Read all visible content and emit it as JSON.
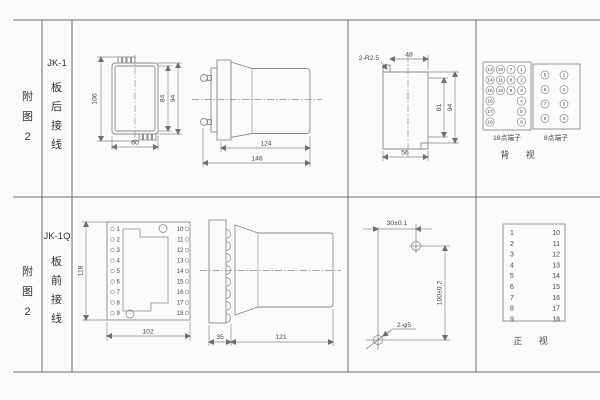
{
  "row1": {
    "fig": "附图2",
    "model": "JK-1",
    "wiring": "板后接线",
    "rear_view": {
      "d_height": "106",
      "d_inner": "84",
      "d_outer": "94",
      "d_width": "60"
    },
    "side_view": {
      "d_body": "124",
      "d_total": "146"
    },
    "cutout": {
      "note": "2-R2.5",
      "d_top": "48",
      "d_inner_h": "81",
      "d_outer_h": "94",
      "d_bottom": "56"
    },
    "block18": {
      "label": "18点端子",
      "rows": [
        [
          "13",
          "10",
          "7",
          "1"
        ],
        [
          "14",
          "11",
          "8",
          "2"
        ],
        [
          "15",
          "12",
          "9",
          "3"
        ],
        [
          "16",
          "4"
        ],
        [
          "17",
          "5"
        ],
        [
          "18",
          "6"
        ]
      ]
    },
    "block8": {
      "label": "8点端子",
      "rows": [
        [
          "5",
          "1"
        ],
        [
          "6",
          "2"
        ],
        [
          "7",
          "3"
        ],
        [
          "8",
          "4"
        ]
      ]
    },
    "view_label": "背 视"
  },
  "row2": {
    "fig": "附图2",
    "model": "JK-1Q",
    "wiring": "板前接线",
    "front_panel": {
      "d_height": "118",
      "d_width": "102",
      "left": [
        "1",
        "2",
        "3",
        "4",
        "5",
        "6",
        "7",
        "8",
        "9"
      ],
      "right": [
        "10",
        "11",
        "12",
        "13",
        "14",
        "15",
        "16",
        "17",
        "18"
      ]
    },
    "side_view": {
      "d_flange": "35",
      "d_body": "121"
    },
    "drill": {
      "d_h": "30±0.1",
      "d_v": "100±0.2",
      "holes": "2-φ5"
    },
    "terminal_list": {
      "left": [
        "1",
        "2",
        "3",
        "4",
        "5",
        "6",
        "7",
        "8",
        "9"
      ],
      "right": [
        "10",
        "11",
        "12",
        "13",
        "14",
        "15",
        "16",
        "17",
        "18"
      ],
      "view_label": "正 视"
    }
  }
}
